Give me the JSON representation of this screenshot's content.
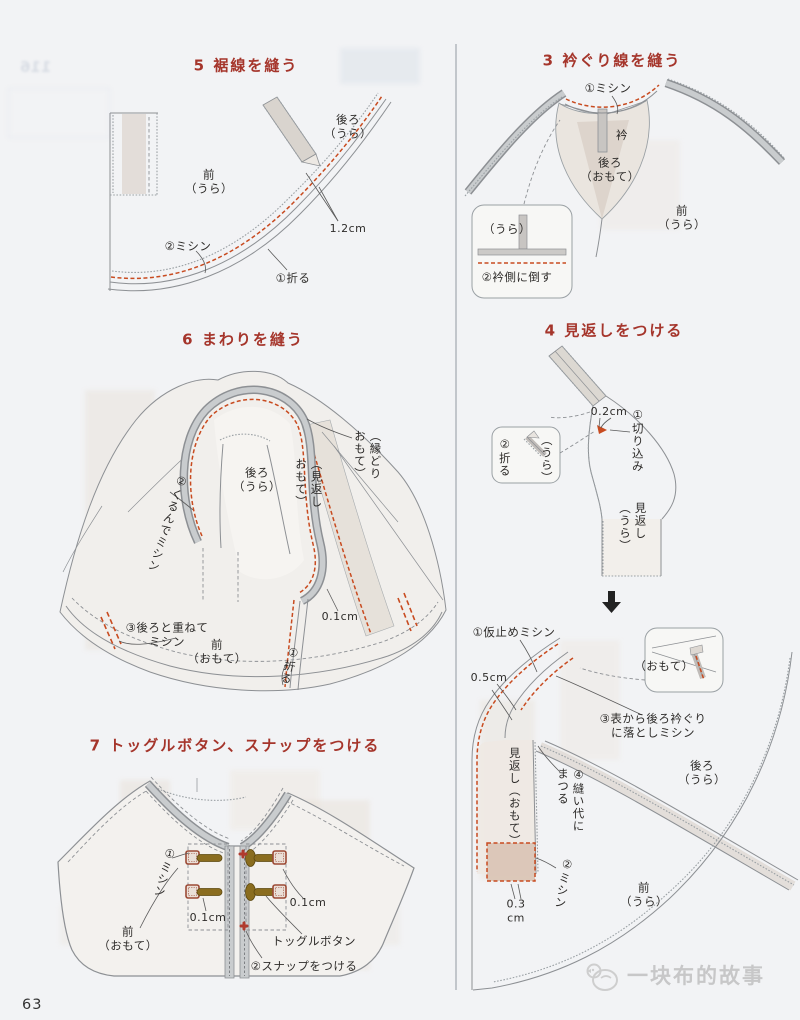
{
  "page": {
    "number": "63",
    "watermark": "一块布的故事"
  },
  "colors": {
    "heading_red": "#a5352b",
    "stitch_red": "#c84b20",
    "outline_gray": "#8d9094",
    "toggle_olive": "#8a6d1f",
    "loop_brown": "#9c4a35",
    "snap_red": "#b03a2e"
  },
  "ghost": {
    "top_left": "116"
  },
  "s5": {
    "title": "5 裾線を縫う",
    "back": "後ろ\n（うら）",
    "front": "前\n（うら）",
    "measure_12": "1.2cm",
    "step2": "②ミシン",
    "step1": "①折る"
  },
  "s3": {
    "title": "3 衿ぐり線を縫う",
    "step1": "①ミシン",
    "collar": "衿",
    "back": "後ろ\n（おもて）",
    "front": "前\n（うら）",
    "inset_ura": "（うら）",
    "inset_step2": "②衿側に倒す"
  },
  "s6": {
    "title": "6 まわりを縫う",
    "back": "後ろ\n（うら）",
    "facing": "（見返し\nおもて）",
    "binding": "（縁どり\nおもて）",
    "step2": "②くるんでミシン",
    "step3": "③後ろと重ねて\nミシン",
    "front": "前\n（おもて）",
    "step1": "①折る",
    "measure_01": "0.1cm"
  },
  "s4": {
    "title": "4 見返しをつける",
    "measure_02": "0.2cm",
    "step1": "①切り込み",
    "inset_fold": "②折る",
    "inset_ura": "（うら）",
    "facing_ura": "見返し\n（うら）",
    "baste": "①仮止めミシン",
    "measure_05": "0.5cm",
    "inset_omote": "（おもて）",
    "step3": "③表から後ろ衿ぐり\nに落としミシン",
    "step4": "④縫い代に\nまつる",
    "facing_omote": "見返し（おもて）",
    "back": "後ろ\n（うら）",
    "step2": "②ミシン",
    "measure_03": "0.3\ncm",
    "front": "前\n（うら）"
  },
  "s7": {
    "title": "7 トッグルボタン、スナップをつける",
    "step1": "①ミシン",
    "measure_left": "0.1cm",
    "measure_right": "0.1cm",
    "front": "前\n（おもて）",
    "toggle_label": "トッグルボタン",
    "step2": "②スナップをつける"
  }
}
